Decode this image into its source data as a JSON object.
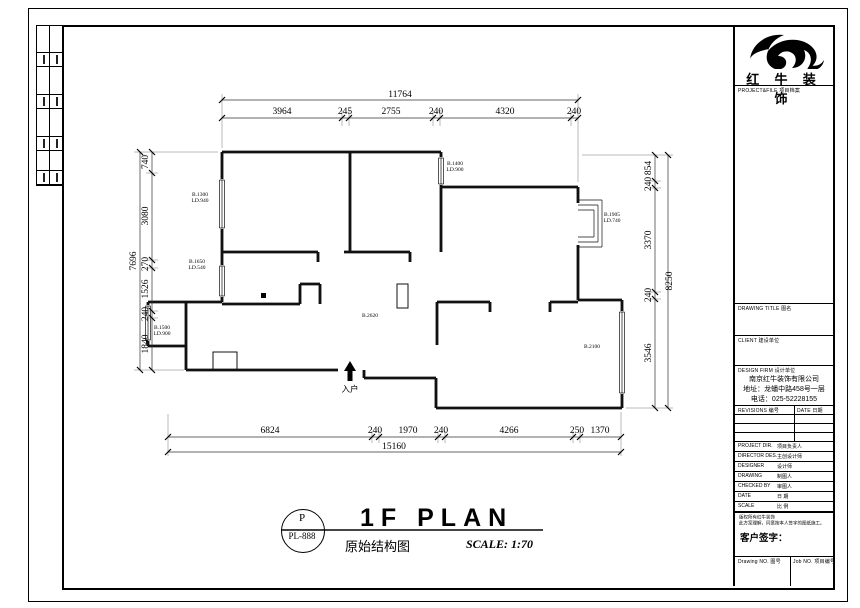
{
  "titleblock": {
    "brand": "红 牛 装 饰",
    "project_file_label": "PROJECT&FILE 项目档案",
    "drawing_title_label": "DRAWING TITLE 图名",
    "client_label": "CLIENT 建设单位",
    "design_firm_label": "DESIGN FIRM 设计单位",
    "company_name": "南京红牛装饰有限公司",
    "company_address": "地址：龙蟠中路458号一层",
    "company_phone": "电话：025-52228155",
    "revisions_label": "REVISIONS 编号",
    "date_col_label": "DATE 日期",
    "rows": [
      {
        "en": "PROJECT DIR.",
        "cn": "项目负责人"
      },
      {
        "en": "DIRECTOR DES.",
        "cn": "主创设计师"
      },
      {
        "en": "DESIGNER",
        "cn": "设计师"
      },
      {
        "en": "DRAWING",
        "cn": "制图人"
      },
      {
        "en": "CHECKED BY",
        "cn": "审图人"
      },
      {
        "en": "DATE",
        "cn": "日 期"
      },
      {
        "en": "SCALE",
        "cn": "比 例"
      }
    ],
    "note_line1": "版权所有红牛装饰",
    "note_line2": "此方案理解，同意按本人签字的图纸施工。",
    "client_sign_label": "客户签字：",
    "drawing_no_label": "Drawing NO. 图号",
    "job_no_label": "Job NO. 项目编号"
  },
  "footer": {
    "stamp_letter": "P",
    "stamp_code": "PL-888",
    "title_en": "1F PLAN",
    "title_cn": "原始结构图",
    "scale_text": "SCALE: 1:70"
  },
  "plan": {
    "entrance_label": "入户",
    "dimensions": {
      "top": {
        "total": "11764",
        "segments": [
          "3964",
          "245",
          "2755",
          "240",
          "4320",
          "240"
        ]
      },
      "bottom": {
        "total": "15160",
        "segments": [
          "6824",
          "240",
          "1970",
          "240",
          "4266",
          "250",
          "1370"
        ]
      },
      "left": {
        "total": "7696",
        "segments": [
          "740",
          "3080",
          "270",
          "1526",
          "240",
          "1840"
        ]
      },
      "right": {
        "total": "8250",
        "segments": [
          "854",
          "240",
          "3370",
          "240",
          "3546"
        ]
      }
    },
    "annotations": [
      {
        "lines": [
          "B.1300",
          "LD.940"
        ]
      },
      {
        "lines": [
          "B.1650",
          "LD.540"
        ]
      },
      {
        "lines": [
          "B.1500",
          "LD.900"
        ]
      },
      {
        "lines": [
          "B.1400",
          "LD.900"
        ]
      },
      {
        "lines": [
          "B.1905",
          "LD.740"
        ]
      },
      {
        "lines": [
          "B.2620"
        ]
      },
      {
        "lines": [
          "B.2100"
        ]
      }
    ]
  }
}
